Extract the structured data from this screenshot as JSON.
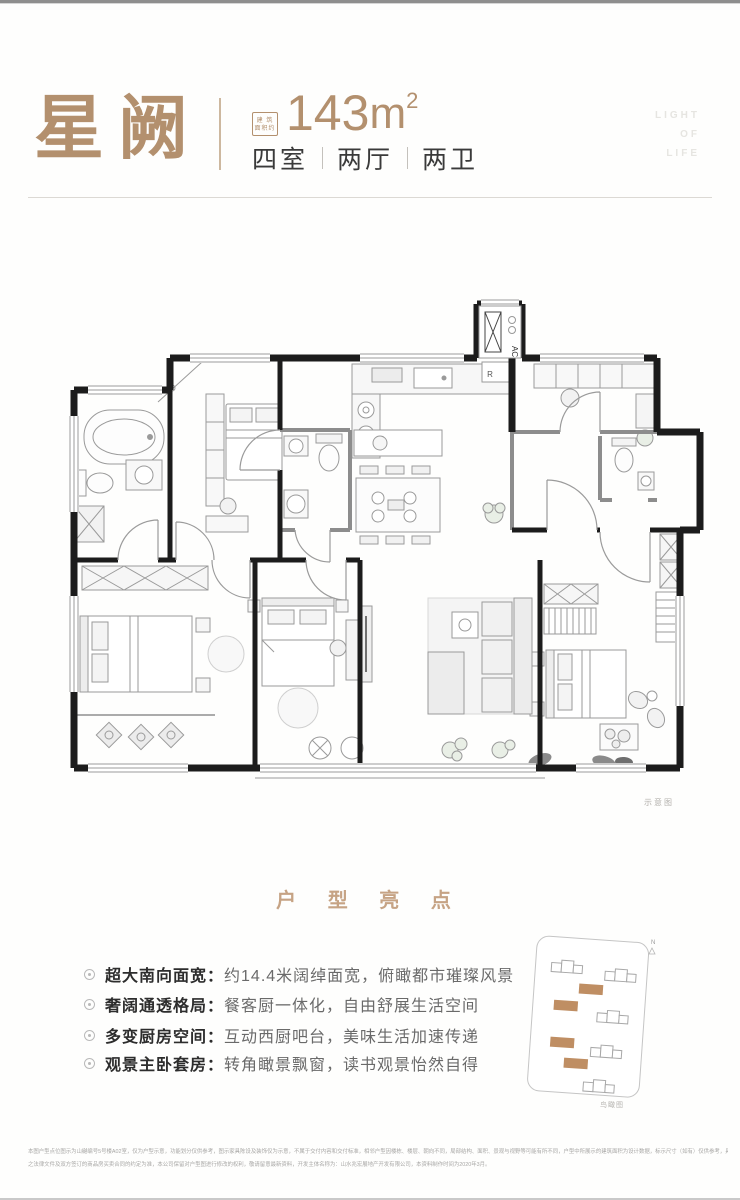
{
  "colors": {
    "accent": "#b3906e",
    "highlightTitle": "#c6a384",
    "dark": "#2d2d2d",
    "desc": "#6a6a6a",
    "siteTan": "#bf8e63",
    "faint": "#e6e5e1"
  },
  "header": {
    "title": "星阙",
    "area_box_line1": "建 筑",
    "area_box_line2": "面积约",
    "area_value": "143",
    "area_unit": "m",
    "area_exp": "2",
    "rooms": [
      "四室",
      "两厅",
      "两卫"
    ],
    "watermark": [
      "LIGHT",
      "OF",
      "LIFE"
    ]
  },
  "floorplan": {
    "ac_label": "AC",
    "fridge_label": "R",
    "caption": "示意图"
  },
  "highlights": {
    "title": "户 型 亮 点",
    "items": [
      {
        "label": "超大南向面宽：",
        "desc": "约14.4米阔绰面宽，俯瞰都市璀璨风景"
      },
      {
        "label": "奢阔通透格局：",
        "desc": "餐客厨一体化，自由舒展生活空间"
      },
      {
        "label": "多变厨房空间：",
        "desc": "互动西厨吧台，美味生活加速传递"
      },
      {
        "label": "观景主卧套房：",
        "desc": "转角瞰景飘窗，读书观景怡然自得"
      }
    ]
  },
  "siteplan": {
    "caption": "鸟瞰图",
    "north": "N"
  },
  "disclaimer": {
    "line1": "本图户型点位图示为山樾编号5号楼A02室，仅为户型示意，功能划分仅供参考，图示家具陈设及装饰仅为示意，不属于交付内容和交付标准，相邻户型因楼栋、楼层、朝向不同，局部结构、面积、景观与视野等可能有所不同，户型中所展示的建筑面积为设计数据，标示尺寸（如有）仅供参考，具体面积、尺寸等以政府最终批准",
    "line2": "之法律文件及双方签订的商品房买卖合同的约定为准，本公司保留对户型图进行修改的权利，敬请留意最新资料，开发主体名称为：山水兆宏展地产开发有限公司，本资料制作时间为2020年3月。"
  }
}
